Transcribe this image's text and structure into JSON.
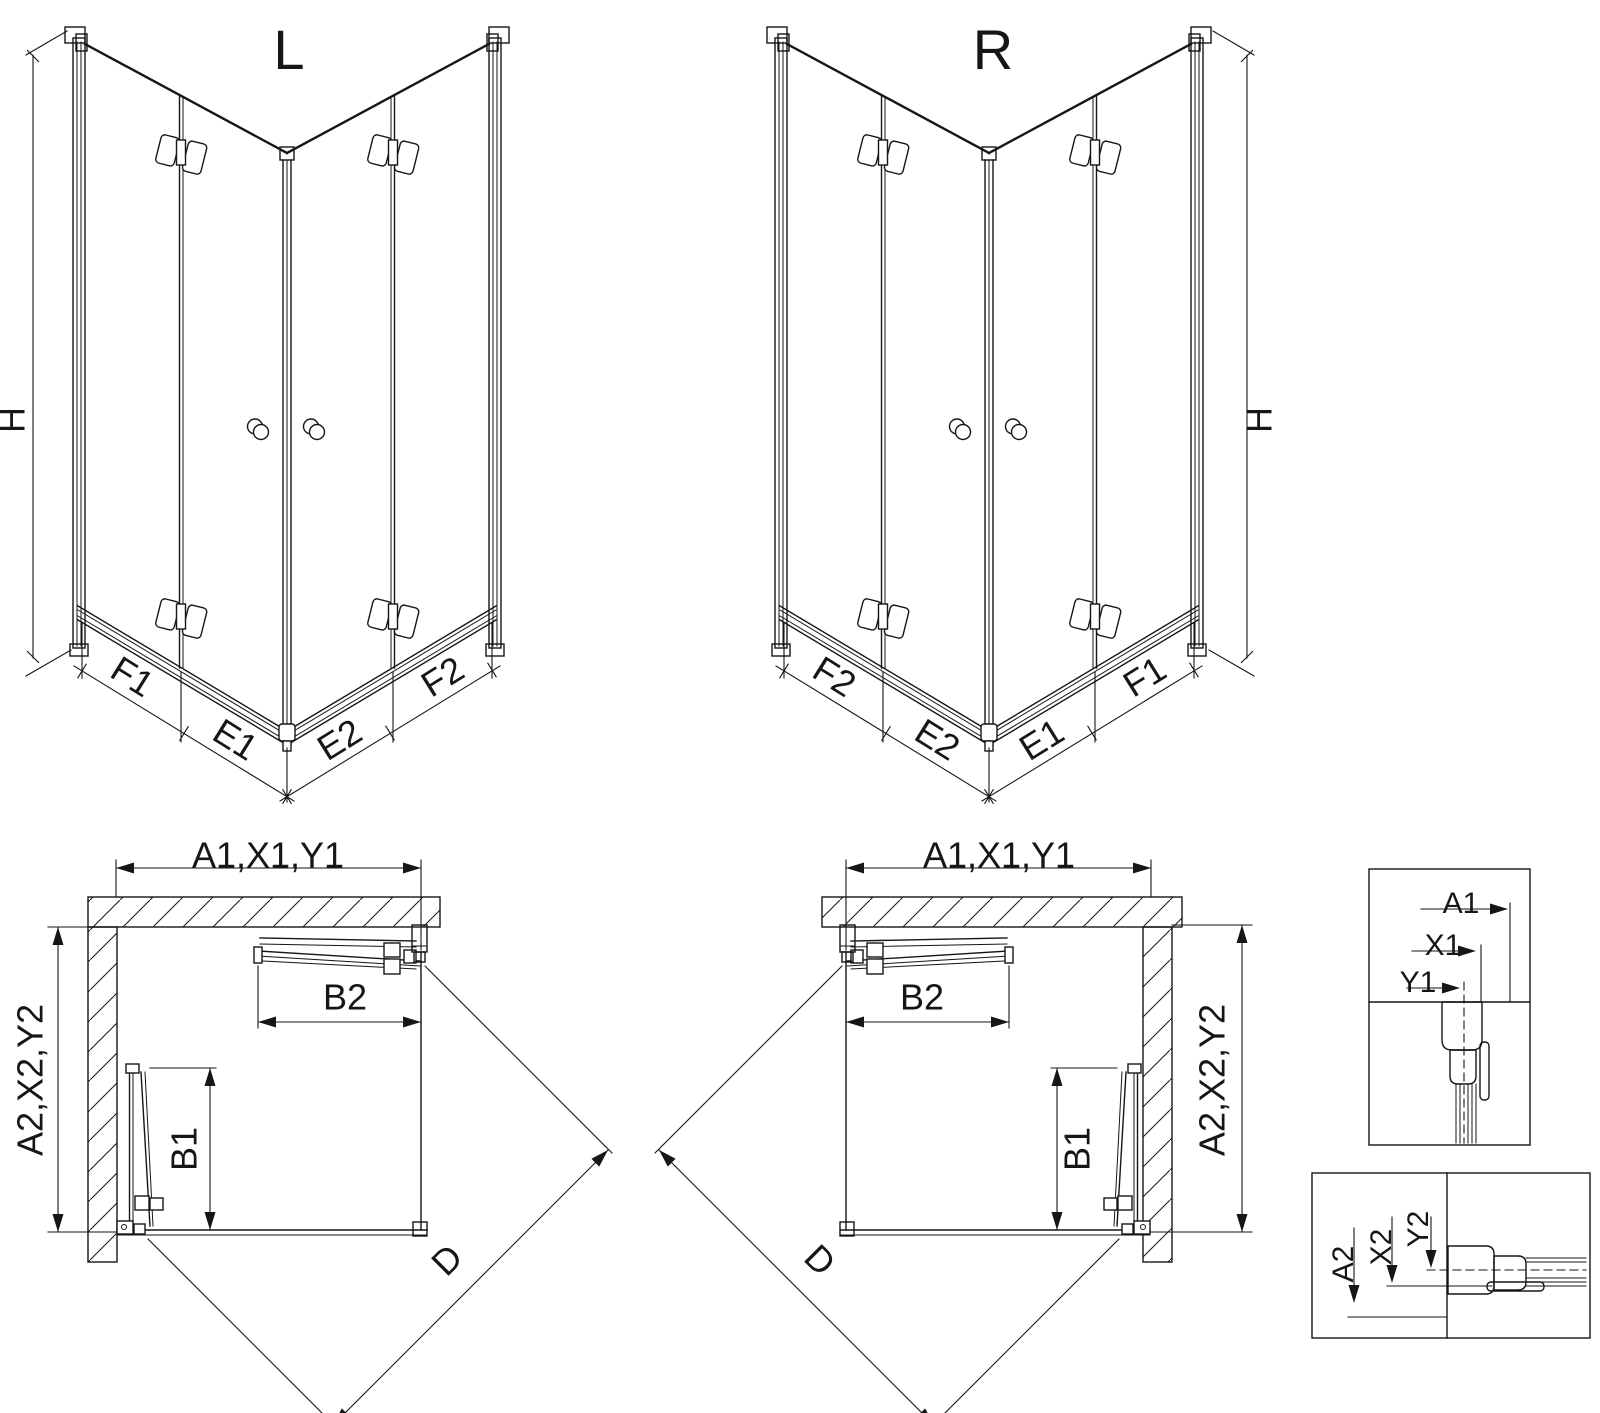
{
  "colors": {
    "line": "#161616",
    "background": "#ffffff"
  },
  "iso_left": {
    "variant_label": "L",
    "height_label": "H",
    "bottom_segments": [
      "F1",
      "E1",
      "E2",
      "F2"
    ]
  },
  "iso_right": {
    "variant_label": "R",
    "height_label": "H",
    "bottom_segments": [
      "F2",
      "E2",
      "E1",
      "F1"
    ]
  },
  "plan_left": {
    "width_label": "A1,X1,Y1",
    "depth_label": "A2,X2,Y2",
    "door_side_label": "B1",
    "door_top_label": "B2",
    "diagonal_label": "D"
  },
  "plan_right": {
    "width_label": "A1,X1,Y1",
    "depth_label": "A2,X2,Y2",
    "door_side_label": "B1",
    "door_top_label": "B2",
    "diagonal_label": "D"
  },
  "detail_top": {
    "labels": [
      "A1",
      "X1",
      "Y1"
    ]
  },
  "detail_bottom": {
    "labels": [
      "A2",
      "X2",
      "Y2"
    ]
  }
}
